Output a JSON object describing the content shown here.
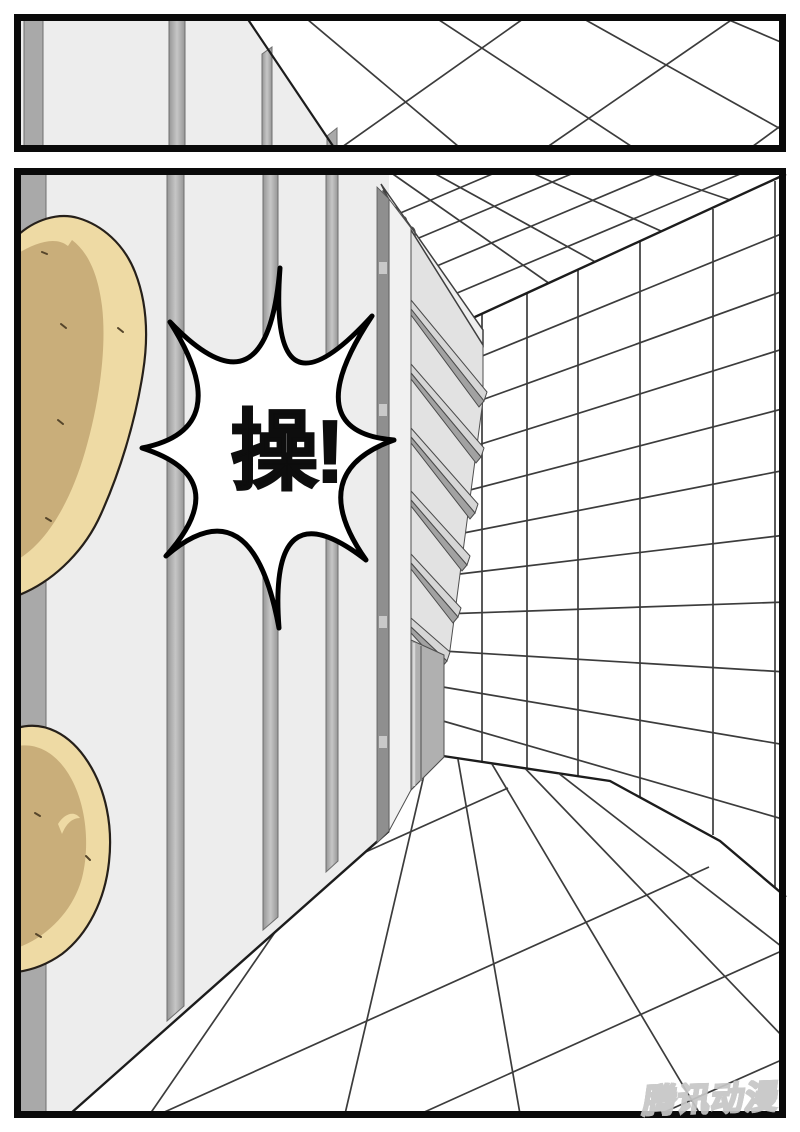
{
  "speech_burst": {
    "text": "操!"
  },
  "watermark": {
    "text": "腾讯动漫"
  },
  "colors": {
    "panel_border": "#0a0a0a",
    "wall": "#ededed",
    "wall_strip": "#b4b4b4",
    "wall_strip_dark": "#a9a9a9",
    "grid_line": "#3c3c3c",
    "boundary_line": "#1c1c1c",
    "bread_light": "#eedaa4",
    "bread_shadow": "#c9ae7a",
    "shelf_face": "#f1f1f1",
    "shelf_interior": "#e2e2e2",
    "shelf_edge_dark": "#8f8f8f",
    "burst_fill": "#ffffff",
    "burst_stroke": "#000000",
    "watermark_color": "#c6c6c6"
  }
}
